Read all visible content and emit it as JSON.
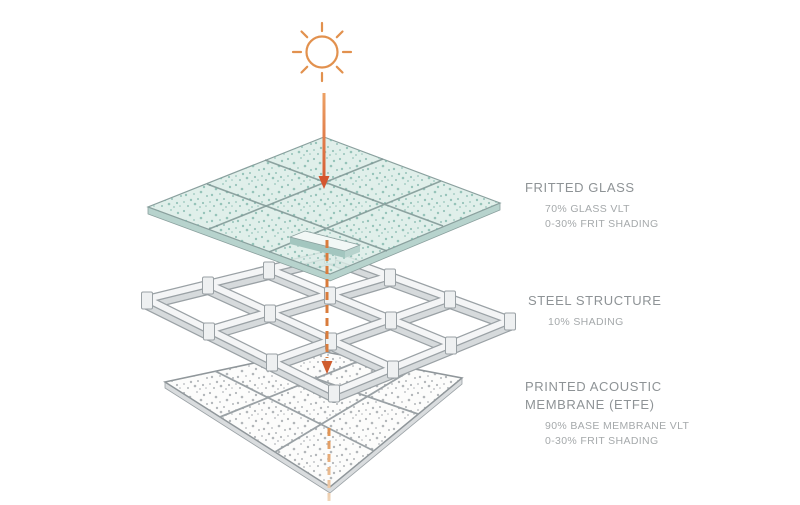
{
  "layers": [
    {
      "id": "fritted-glass",
      "name": "FRITTED GLASS",
      "details": [
        "70% GLASS VLT",
        "0-30% FRIT SHADING"
      ]
    },
    {
      "id": "steel-structure",
      "name": "STEEL STRUCTURE",
      "details": [
        "10% SHADING"
      ]
    },
    {
      "id": "printed-acoustic-membrane",
      "name": "PRINTED ACOUSTIC MEMBRANE (ETFE)",
      "details": [
        "90% BASE MEMBRANE VLT",
        "0-30% FRIT SHADING"
      ]
    }
  ],
  "icons": {
    "sun": "sun-icon",
    "light_arrow": "downward-light-arrow"
  },
  "colors": {
    "sun_orange": "#e2914e",
    "arrow_head_red": "#d4552f",
    "dashed_arrow_orange": "#d97c3c",
    "glass_fill": "#d9ebe5",
    "glass_frit_dot": "#79b1a6",
    "steel_face": "#f4f5f6",
    "steel_edge": "#9aa1a5",
    "membrane_fill": "#fcfcfb",
    "membrane_dot": "#999fa3",
    "heading_text": "#8e9396",
    "detail_text": "#a5a9ab",
    "background": "#ffffff"
  }
}
